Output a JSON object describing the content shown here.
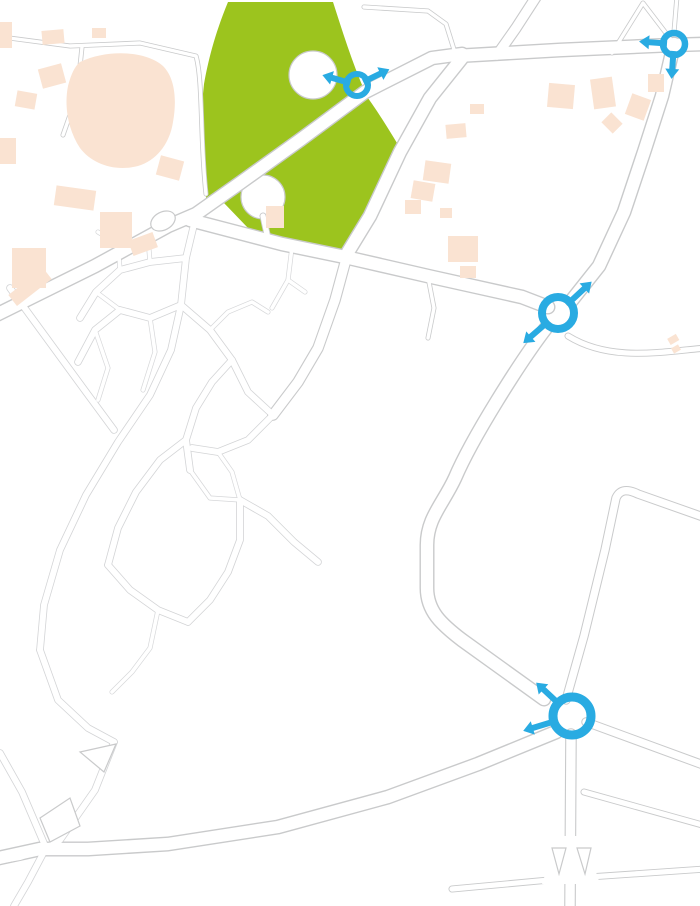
{
  "map": {
    "description": "Road-works detour map of Salouël / Amiens university district",
    "colors": {
      "detour_blue": "#29abe2",
      "closure_red": "#d9161f",
      "park_green": "#9cc41e",
      "building_beige": "#fae3d2",
      "road_casing": "#c9cacb",
      "road_label_gray": "#8a8c8f",
      "poi_text": "#3f4043",
      "warning_yellow": "#fdc500",
      "warning_border": "#e23b26"
    },
    "labels": [
      {
        "id": "hopital-sud",
        "text": "HOPITAL SUD",
        "x": 171,
        "y": 116,
        "rot": 0,
        "size": 11,
        "style": "institution",
        "spacing": 1
      },
      {
        "id": "av-de-la-croix-jourdain",
        "text": "Av. de la Croix Jourdain",
        "x": 267,
        "y": 133,
        "rot": -36,
        "size": 13.5,
        "style": "road"
      },
      {
        "id": "av-albert-camus",
        "text": "Av. Albert Camus",
        "x": 278,
        "y": 258,
        "rot": 9,
        "size": 14,
        "style": "road"
      },
      {
        "id": "avenue-des-facultes",
        "text": "Avenue des Facultés",
        "x": 399,
        "y": 166,
        "rot": -57,
        "size": 14,
        "style": "road"
      },
      {
        "id": "av-du-golf",
        "text": "Av. du Golf",
        "x": 355,
        "y": 302,
        "rot": -71,
        "size": 13,
        "style": "road"
      },
      {
        "id": "rue-j-moulin",
        "lines": [
          "Rue J.",
          "Moulin"
        ],
        "x": 530,
        "y": 26,
        "rot": -38,
        "size": 13.5,
        "style": "road"
      },
      {
        "id": "av-paul-claudel",
        "text": "Av. Paul Claudel",
        "x": 612,
        "y": 73,
        "rot": -4,
        "size": 14.5,
        "style": "road"
      },
      {
        "id": "d210-north",
        "text": "D210",
        "x": 637,
        "y": 180,
        "rot": -69,
        "size": 13,
        "style": "road"
      },
      {
        "id": "d210-mid",
        "text": "D210",
        "x": 478,
        "y": 463,
        "rot": -61,
        "size": 13,
        "style": "road"
      },
      {
        "id": "d210-south",
        "text": "D210",
        "x": 375,
        "y": 808,
        "rot": -11,
        "size": 13,
        "style": "road"
      },
      {
        "id": "salouel",
        "text": "SALOUËL",
        "x": 244,
        "y": 341,
        "rot": 0,
        "size": 14,
        "style": "town",
        "spacing": 1.5
      },
      {
        "id": "residence-universitaire-du-bailly",
        "lines": [
          "Résidence",
          "Universitaire",
          "du Bailly"
        ],
        "x": 497,
        "y": 95,
        "rot": 0,
        "size": 10.5,
        "style": "poi"
      },
      {
        "id": "cnam-hdf",
        "lines": [
          "Cnam",
          "HDF"
        ],
        "x": 396,
        "y": 130,
        "rot": 0,
        "size": 10.5,
        "style": "poi"
      },
      {
        "id": "iut-amiens",
        "lines": [
          "IUT Amiens",
          "Institut universitaire",
          "de technologie"
        ],
        "x": 421,
        "y": 231,
        "rot": 0,
        "size": 10.5,
        "style": "poi"
      },
      {
        "id": "rue-s-mahlangu",
        "text": "Rue S. Mahlangu",
        "x": 398,
        "y": 11,
        "rot": 0,
        "size": 5,
        "style": "tiny",
        "boxed": true
      },
      {
        "id": "ch-du-thil",
        "text": "Ch. du Thil",
        "x": 441,
        "y": 27,
        "rot": -58,
        "size": 5,
        "style": "tiny"
      },
      {
        "id": "rue-de-l-ours",
        "text": "Rue de l'Ours",
        "x": 626,
        "y": 31,
        "rot": -57,
        "size": 5,
        "style": "tiny"
      },
      {
        "id": "et-de-la-lune",
        "text": "et de la lune",
        "x": 657,
        "y": 20,
        "rot": 53,
        "size": 5,
        "style": "tiny"
      }
    ],
    "no_entry_signs": [
      {
        "x": 207,
        "y": 217
      },
      {
        "x": 455,
        "y": 85
      },
      {
        "x": 520,
        "y": 296
      },
      {
        "x": 275,
        "y": 424
      }
    ],
    "construction_sign": {
      "x": 348,
      "y": 250
    },
    "detour_arrows": [
      {
        "x": 427,
        "y": 47,
        "rot": -17,
        "len": 42
      },
      {
        "x": 584,
        "y": 56,
        "rot": -7,
        "len": 46
      },
      {
        "x": 626,
        "y": 176,
        "rot": -69,
        "len": 44
      },
      {
        "x": 264,
        "y": 157,
        "rot": -37,
        "len": 54
      },
      {
        "x": 466,
        "y": 457,
        "rot": -60,
        "len": 46
      },
      {
        "x": 426,
        "y": 578,
        "rot": -84,
        "len": 44
      },
      {
        "x": 502,
        "y": 664,
        "rot": -41,
        "len": 46
      },
      {
        "x": 432,
        "y": 773,
        "rot": -27,
        "len": 42
      },
      {
        "x": 268,
        "y": 826,
        "rot": -12,
        "len": 46
      },
      {
        "x": 93,
        "y": 862,
        "rot": -9,
        "len": 44
      }
    ],
    "roundabouts": [
      {
        "id": "croix-jourdain-roundabout",
        "x": 357,
        "y": 85,
        "r": 11,
        "stroke": 6,
        "arrows": [
          {
            "rot": 196,
            "len": 25
          },
          {
            "rot": -26,
            "len": 25
          }
        ]
      },
      {
        "id": "paul-claudel-roundabout",
        "x": 674,
        "y": 44,
        "r": 11,
        "stroke": 6.5,
        "arrows": [
          {
            "rot": 184,
            "len": 24
          },
          {
            "rot": 94,
            "len": 24
          }
        ]
      },
      {
        "id": "d210-north-roundabout",
        "x": 558,
        "y": 313,
        "r": 16,
        "stroke": 8,
        "arrows": [
          {
            "rot": -43,
            "len": 30
          },
          {
            "rot": 139,
            "len": 30
          }
        ]
      },
      {
        "id": "d210-south-roundabout",
        "x": 572,
        "y": 716,
        "r": 19,
        "stroke": 9,
        "arrows": [
          {
            "rot": -137,
            "len": 30
          },
          {
            "rot": 163,
            "len": 32
          }
        ]
      }
    ]
  }
}
